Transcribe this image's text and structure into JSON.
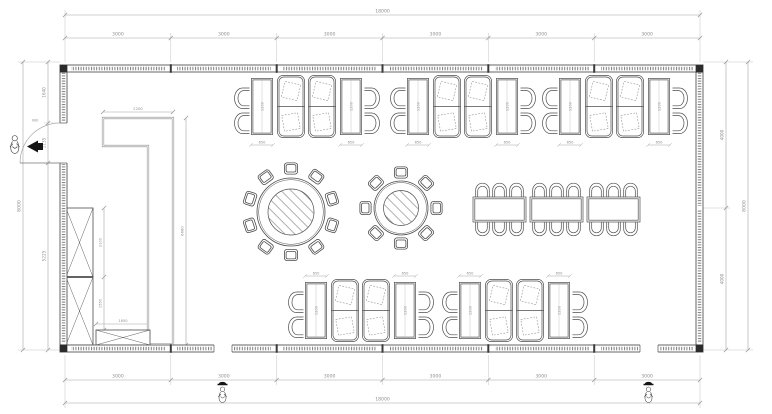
{
  "page": {
    "background": "#ffffff"
  },
  "drawing": {
    "type": "floor-plan",
    "description": "restaurant dining room plan with booth seating, round banquet tables, long table, bar counter and cabinets",
    "dims": {
      "top_total": "18000",
      "top_segments": [
        "3000",
        "3000",
        "3000",
        "3000",
        "3000",
        "3000"
      ],
      "bottom_segments": [
        "3000",
        "3000",
        "3000",
        "3000",
        "3000",
        "3000"
      ],
      "bottom_total": "18000",
      "left_total": "8000",
      "left_segments": [
        "1640",
        "1135",
        "5225"
      ],
      "door_width": "900",
      "right_segments": [
        "4000",
        "4000"
      ],
      "right_total": "8000",
      "counter_length": "2200",
      "counter_depth": "6680",
      "cabinet_upper_height": "2100",
      "cabinet_lower_height": "1550",
      "cabinet_width": "1650",
      "table_width": "650",
      "table_length": "1200"
    },
    "colors": {
      "wall_line": "#555555",
      "furniture_line": "#4d4d4d",
      "dim_line": "#a6a6a6",
      "dim_text": "#8f8f8f",
      "column_fill": "#2b2b2b",
      "marker_fill": "#151515"
    },
    "icons": {
      "person-figure": "sketched person with black hat marker",
      "section-marker": "filled triangle with bar",
      "door-swing": "quarter-circle arc"
    }
  }
}
